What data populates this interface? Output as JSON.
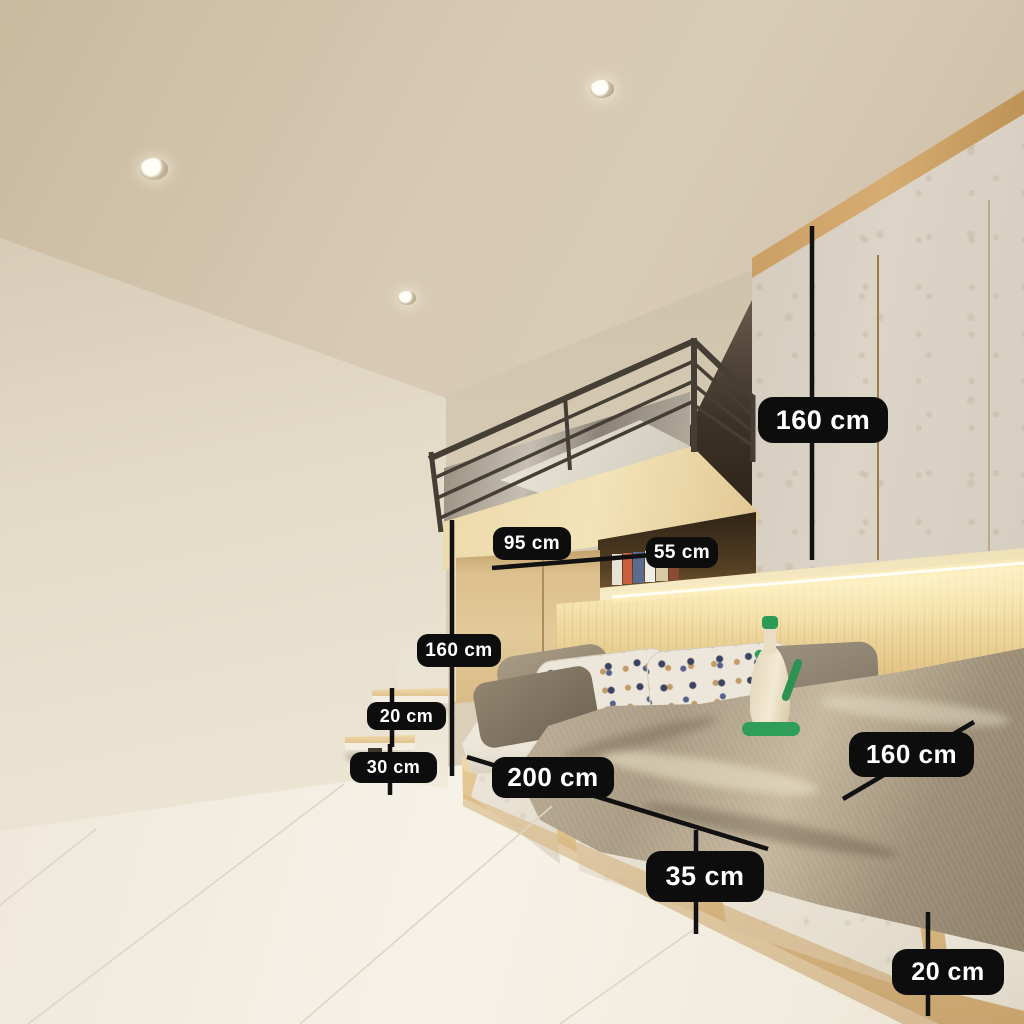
{
  "scene": {
    "description": "3D interior render of a compact bedroom: loft bed with dark metal railing above a wooden wardrobe column, marble-front overhead wardrobe, LED-lit wood slat headboard, storage platform bed with marble drawer fronts, floating wooden wall steps, recessed ceiling spotlights, marble tile floor. Black dimension callouts annotate the furniture."
  },
  "annotations": {
    "wardrobe_height": {
      "text": "160 cm"
    },
    "cabinet_top_depth": {
      "text": "95 cm"
    },
    "shelf_depth": {
      "text": "55 cm"
    },
    "column_height": {
      "text": "160 cm"
    },
    "step_rise_upper": {
      "text": "20 cm"
    },
    "step_rise_lower": {
      "text": "30 cm"
    },
    "bed_length": {
      "text": "200 cm"
    },
    "bed_width": {
      "text": "160 cm"
    },
    "base_height": {
      "text": "35 cm"
    },
    "drawer_height": {
      "text": "20 cm"
    }
  },
  "colors": {
    "label_bg": "#0d0d0d",
    "label_text": "#ffffff",
    "dimension_line": "#111111",
    "wall": "#e3dac7",
    "ceiling": "#d5c7b1",
    "wood_light": "#e3ca99",
    "marble": "#dcd4c7",
    "railing": "#453e35",
    "led_glow": "#fff4cd",
    "blanket": "#a99b83",
    "bottle_green": "#2f9e58"
  }
}
